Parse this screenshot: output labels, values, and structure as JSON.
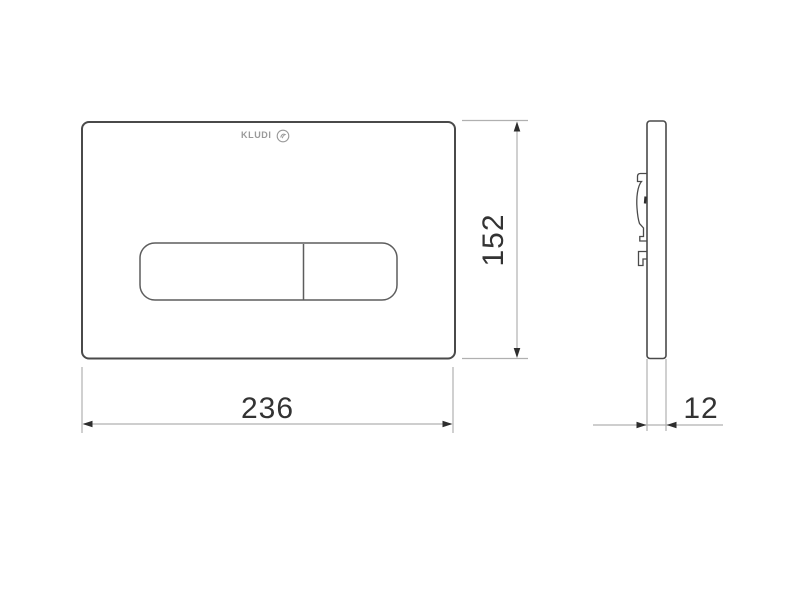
{
  "logo": {
    "text": "KLUDI",
    "icon": "kludi-circle-logo-icon"
  },
  "dimensions": {
    "width": "236",
    "height": "152",
    "depth": "12"
  },
  "colors": {
    "background": "#ffffff",
    "outline": "#4a4a4a",
    "button_outline": "#5d5d5d",
    "dimension_line": "#b0b0b0",
    "arrow": "#2e2e2e",
    "text": "#333333",
    "logo": "#9a9a9a"
  }
}
